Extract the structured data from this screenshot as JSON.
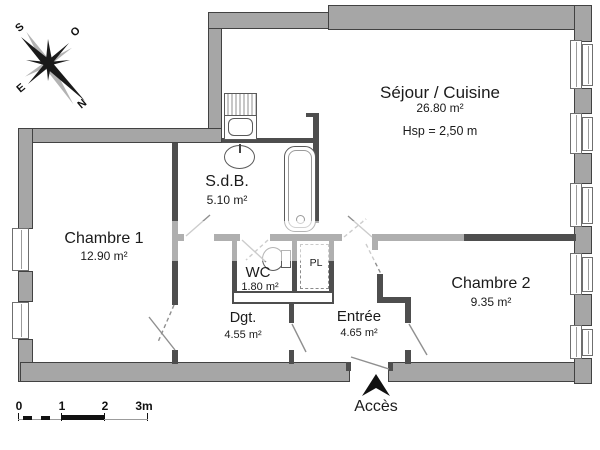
{
  "plan": {
    "rooms": {
      "sejour": {
        "name": "Séjour / Cuisine",
        "area": "26.80 m²",
        "height_note": "Hsp =  2,50 m"
      },
      "chambre1": {
        "name": "Chambre 1",
        "area": "12.90 m²"
      },
      "chambre2": {
        "name": "Chambre 2",
        "area": "9.35 m²"
      },
      "sdb": {
        "name": "S.d.B.",
        "area": "5.10 m²"
      },
      "wc": {
        "name": "WC",
        "area": "1.80 m²"
      },
      "dgt": {
        "name": "Dgt.",
        "area": "4.55 m²"
      },
      "entree": {
        "name": "Entrée",
        "area": "4.65 m²"
      },
      "placard": {
        "label": "PL"
      }
    },
    "access_label": "Accès",
    "compass": {
      "north": "N",
      "south": "S",
      "east": "E",
      "west": "O"
    },
    "scale_bar": {
      "labels": [
        "0",
        "1",
        "2",
        "3m"
      ]
    },
    "colors": {
      "wall_fill": "#a6a6a6",
      "wall_edge": "#424242",
      "partition": "#4e4e4e",
      "text": "#1b1b1b"
    }
  }
}
